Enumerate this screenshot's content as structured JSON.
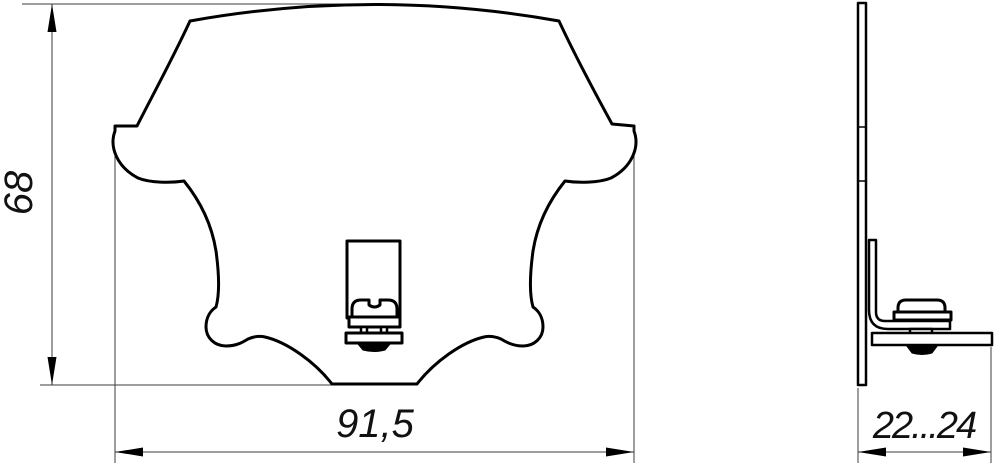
{
  "drawing": {
    "type": "technical-drawing",
    "views": {
      "front": {
        "height_dim": "68",
        "width_dim": "91,5"
      },
      "side": {
        "depth_dim": "22...24"
      }
    },
    "colors": {
      "part_line": "#000000",
      "dimension_line": "#3c3c3c",
      "text": "#111111",
      "background": "#ffffff"
    }
  }
}
